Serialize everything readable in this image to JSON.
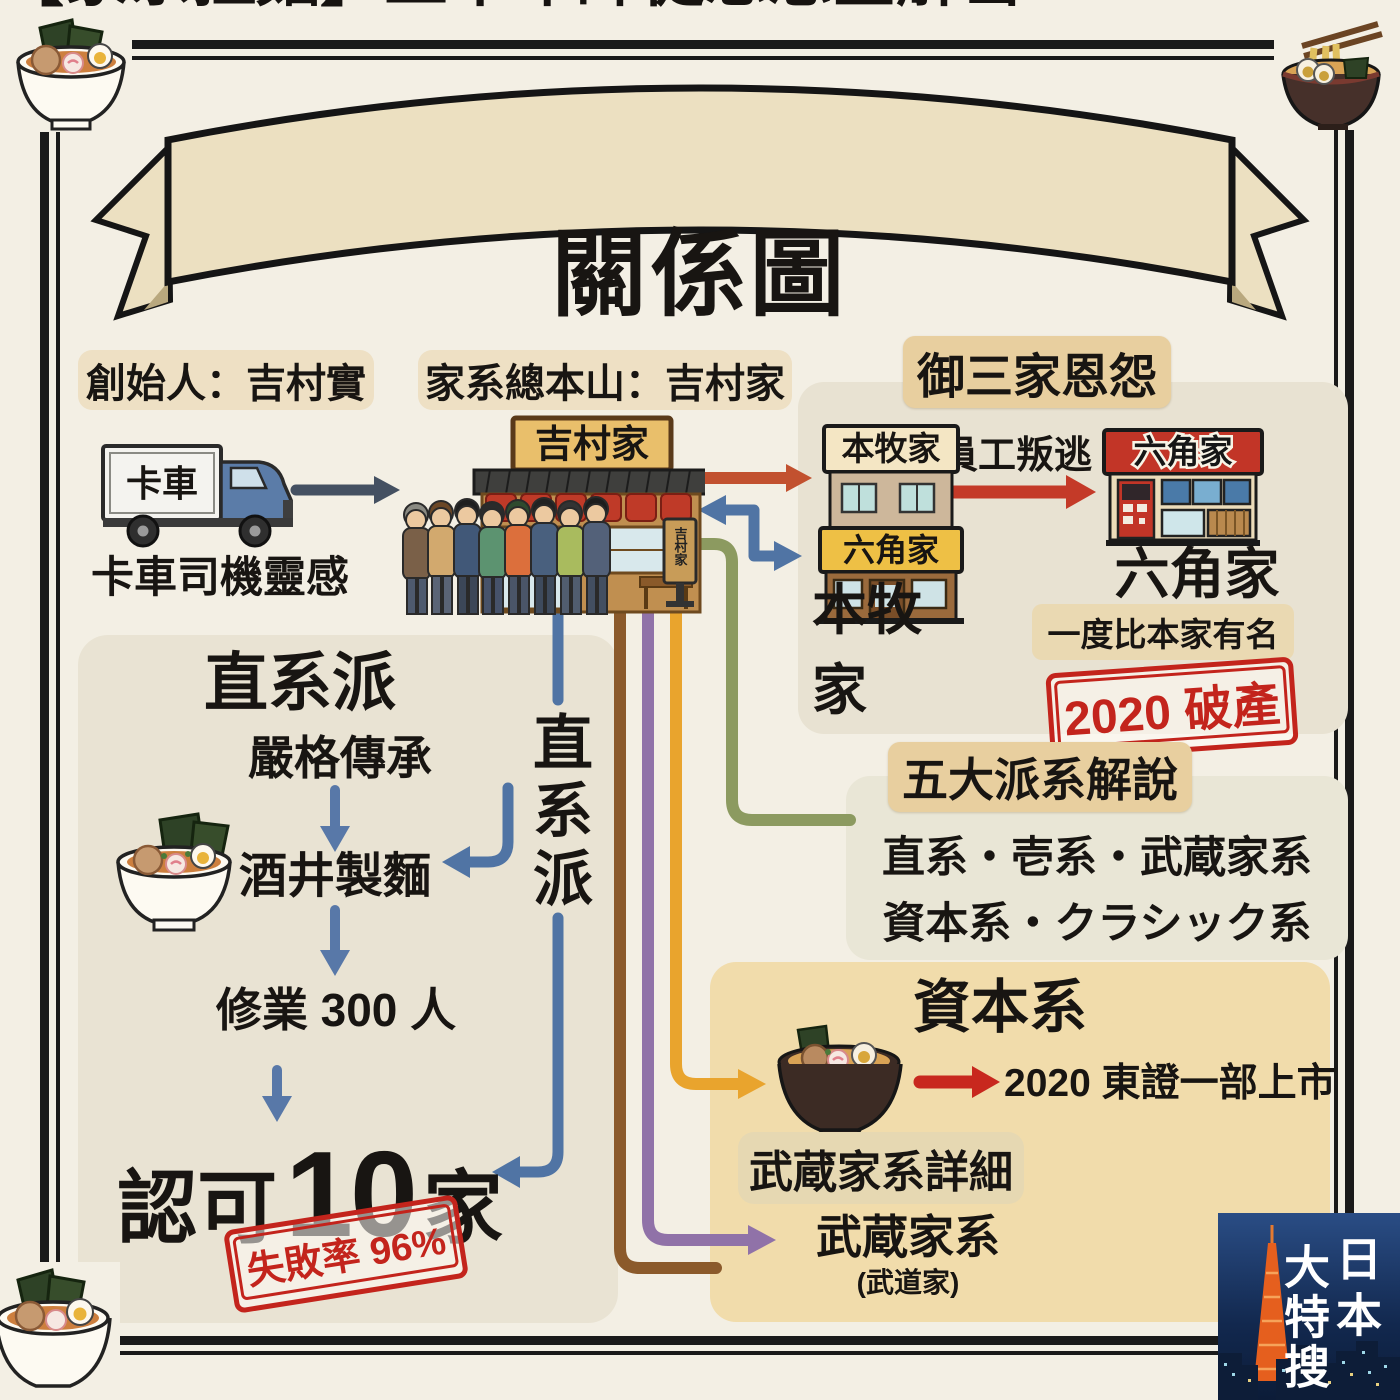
{
  "banner": {
    "title": "【家系拉麵】五十年師徒恩怨全解密",
    "subtitle": "關係圖"
  },
  "origin": {
    "founder_label": "創始人：吉村實",
    "headquarters_label": "家系總本山：吉村家",
    "truck_sign": "卡車",
    "truck_caption": "卡車司機靈感",
    "shop_sign": "吉村家",
    "shop_stand_sign": "吉村家"
  },
  "gosanke": {
    "title": "御三家恩怨",
    "betrayal": "員工叛逃",
    "honmoku": {
      "sign_top": "本牧家",
      "sign_bottom": "六角家",
      "label": "本牧家"
    },
    "rokkakuya": {
      "sign": "六角家",
      "label": "六角家",
      "note": "一度比本家有名",
      "stamp": "2020 破產"
    }
  },
  "five_factions": {
    "title": "五大派系解說",
    "row1": "直系・壱系・武蔵家系",
    "row2": "資本系・クラシック系"
  },
  "chokkei": {
    "title": "直系派",
    "vertical_label": "直系派",
    "step_1": "嚴格傳承",
    "step_2": "酒井製麵",
    "step_3": "修業 300 人",
    "approved_prefix": "認可",
    "approved_count": "10",
    "approved_suffix": "家",
    "stamp": "失敗率 96%"
  },
  "shihon": {
    "title": "資本系",
    "ipo": "2020 東證一部上市",
    "musashi_heading": "武蔵家系詳細",
    "musashi_label": "武蔵家系",
    "musashi_sub": "(武道家)"
  },
  "watermark": {
    "right_column": "日本",
    "left_column": "大特搜"
  },
  "colors": {
    "page_bg": "#f3efe4",
    "panel_bg": "#e9e3d3",
    "tan_box": "#e8cf9f",
    "label_box": "#eee0c4",
    "shihon_box": "#f1dcab",
    "stamp_red": "#c3241c",
    "line_blue": "#5074a4",
    "line_green": "#8c9a60",
    "line_brown": "#8b5a2b",
    "line_purple": "#9072a8",
    "line_orange": "#e9a42d",
    "arrow_red": "#c43a28",
    "arrow_slate": "#445061"
  }
}
